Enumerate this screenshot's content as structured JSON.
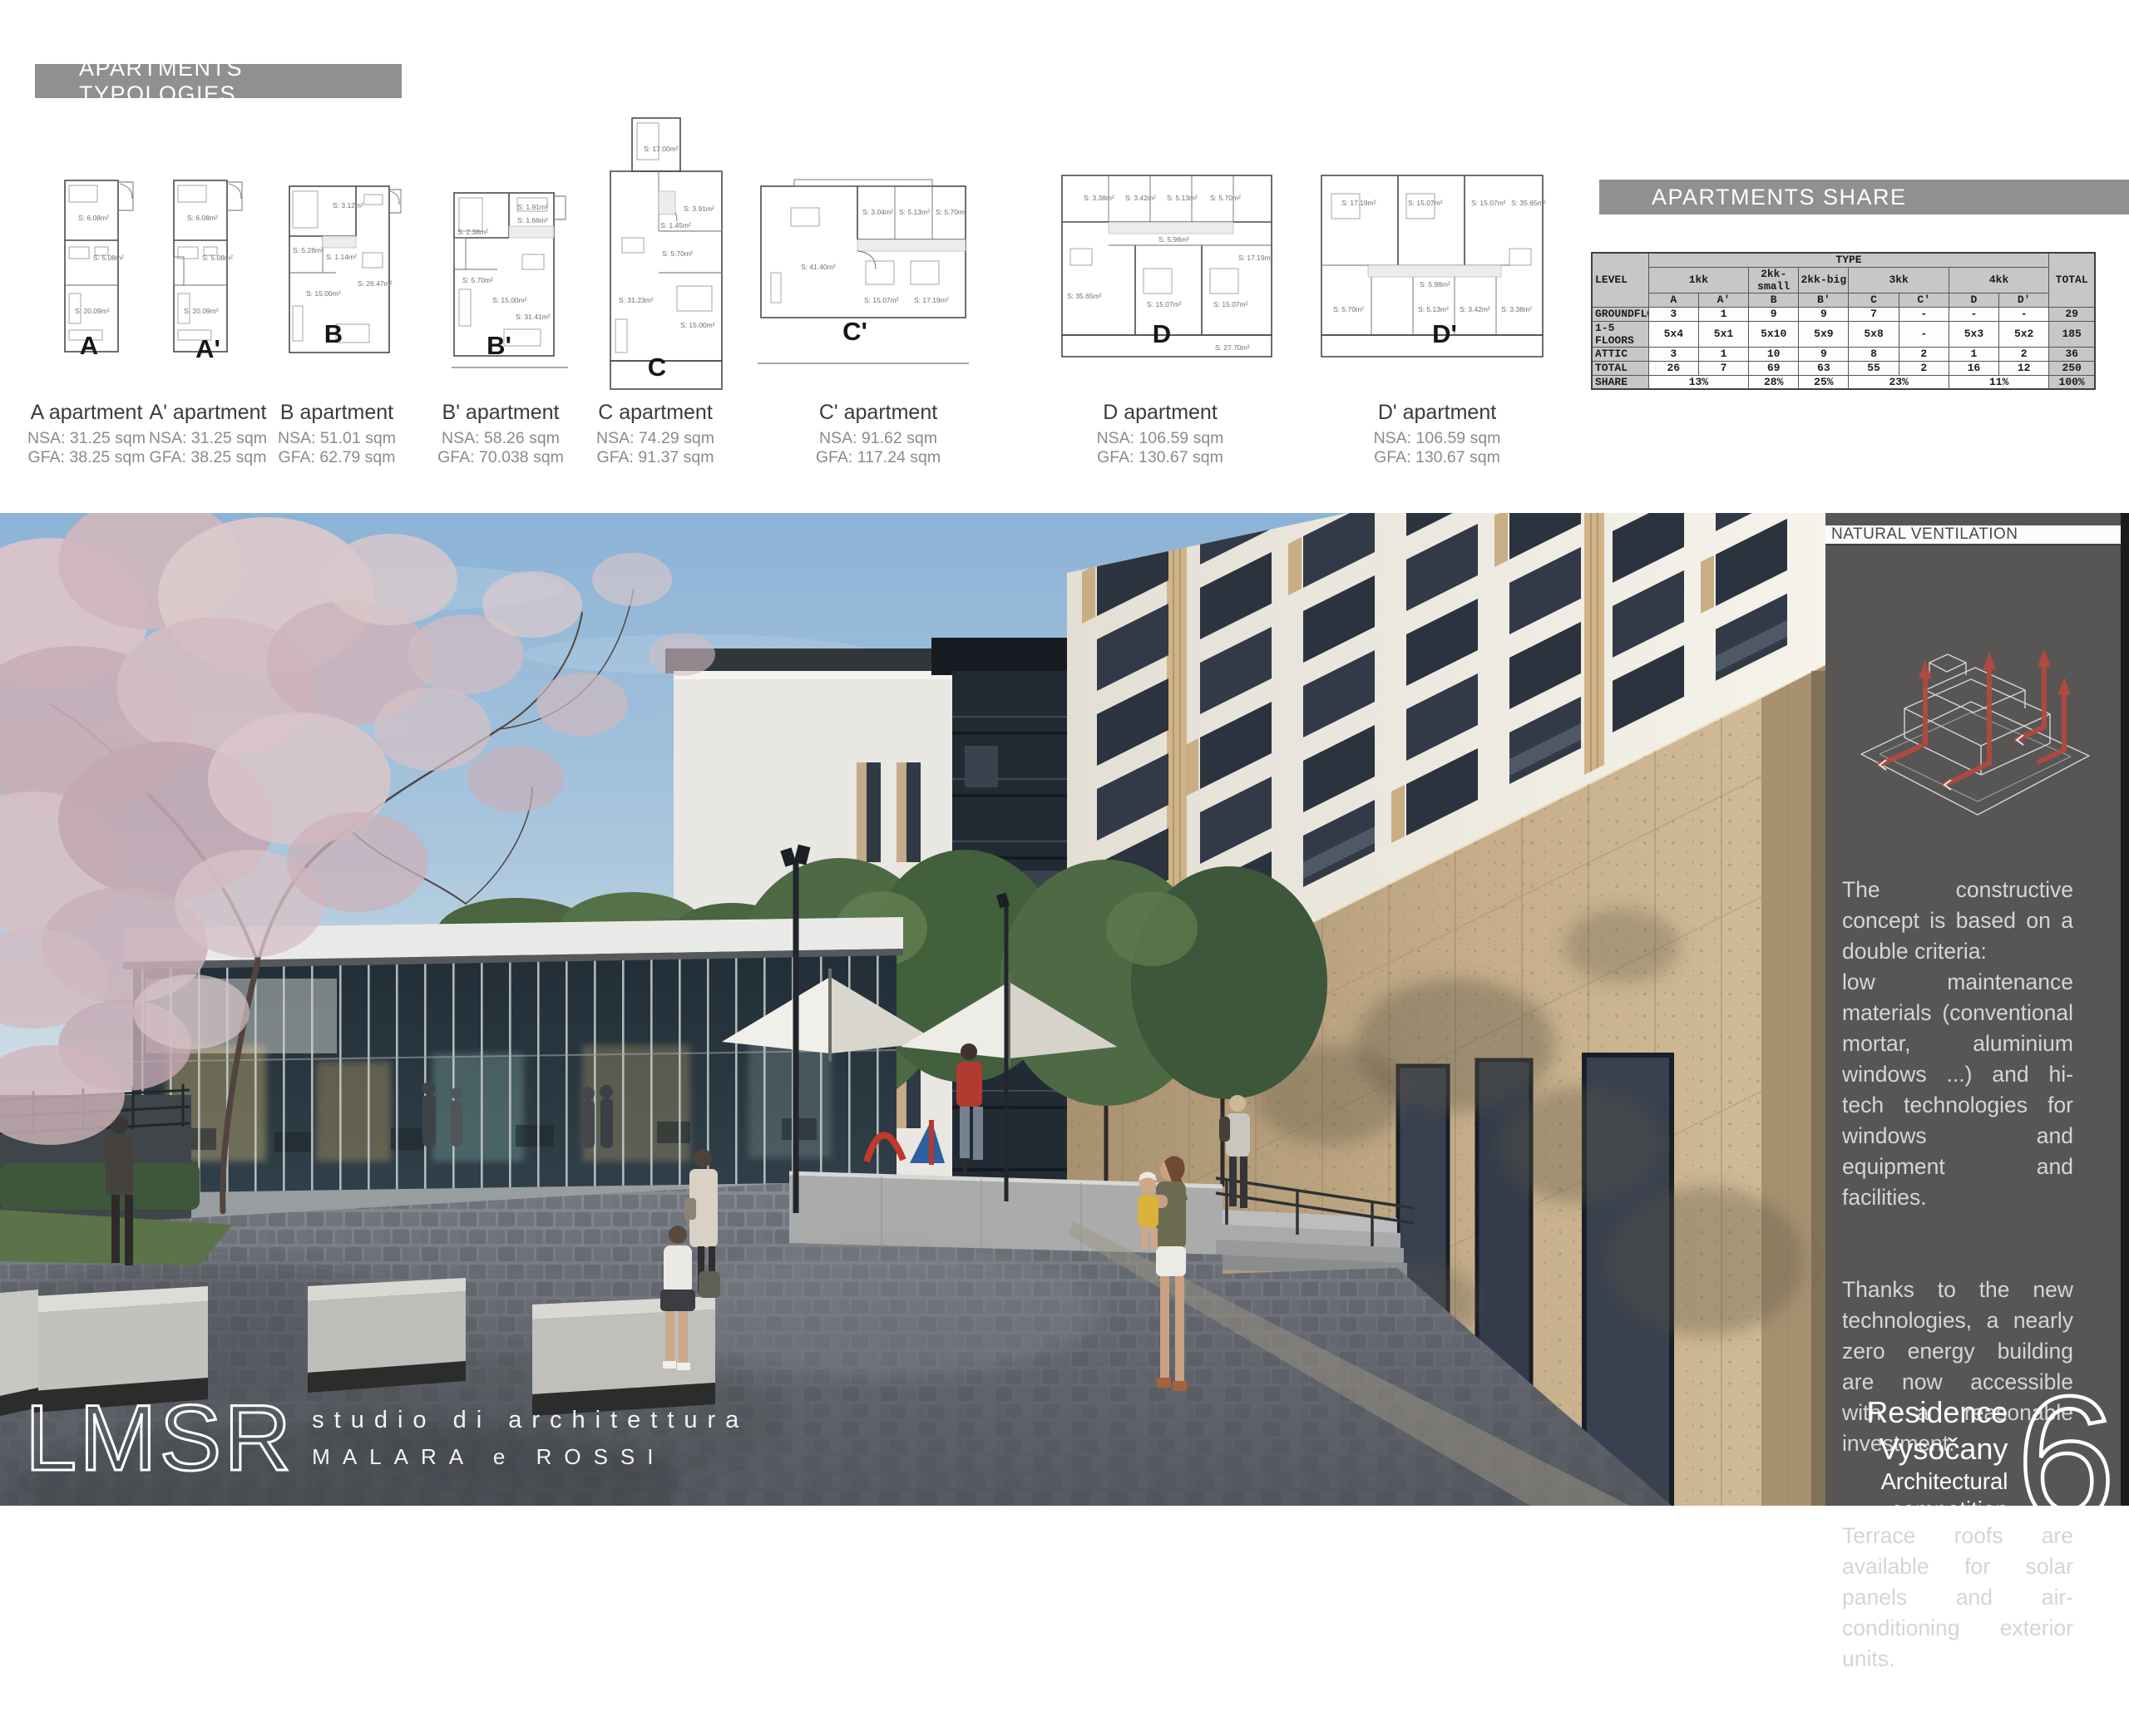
{
  "board": {
    "page_number": "6",
    "project": "Residence Vysočany",
    "competition": "Architectural competition"
  },
  "headers": {
    "typologies": "APARTMENTS TYPOLOGIES",
    "share": "APARTMENTS SHARE",
    "ventilation": "NATURAL VENTILATION"
  },
  "logo": {
    "name": "LMSR",
    "line1": "studio di architettura",
    "line2": "MALARA e ROSSI"
  },
  "typologies": [
    {
      "letter": "A",
      "title": "A apartment",
      "nsa": "NSA: 31.25 sqm",
      "gfa": "GFA: 38.25 sqm",
      "areas": [
        "S: 6.08m²",
        "S: 5.08m²",
        "S: 20.09m²"
      ]
    },
    {
      "letter": "A'",
      "title": "A' apartment",
      "nsa": "NSA: 31.25 sqm",
      "gfa": "GFA: 38.25 sqm",
      "areas": [
        "S: 6.08m²",
        "S: 5.08m²",
        "S: 20.09m²"
      ]
    },
    {
      "letter": "B",
      "title": "B apartment",
      "nsa": "NSA: 51.01 sqm",
      "gfa": "GFA: 62.79 sqm",
      "areas": [
        "S: 3.12m²",
        "S: 5.28m²",
        "S: 1.14m²",
        "S: 26.47m²",
        "S: 15.00m²"
      ]
    },
    {
      "letter": "B'",
      "title": "B' apartment",
      "nsa": "NSA: 58.26 sqm",
      "gfa": "GFA: 70.038 sqm",
      "areas": [
        "S: 1.91m²",
        "S: 1.66m²",
        "S: 2.38m²",
        "S: 5.70m²",
        "S: 15.00m²",
        "S: 31.41m²"
      ]
    },
    {
      "letter": "C",
      "title": "C apartment",
      "nsa": "NSA: 74.29 sqm",
      "gfa": "GFA: 91.37 sqm",
      "areas": [
        "S: 17.00m²",
        "S: 3.91m²",
        "S: 1.45m²",
        "S: 5.70m²",
        "S: 15.00m²",
        "S: 31.23m²"
      ]
    },
    {
      "letter": "C'",
      "title": "C' apartment",
      "nsa": "NSA: 91.62 sqm",
      "gfa": "GFA: 117.24 sqm",
      "areas": [
        "S: 3.04m²",
        "S: 5.13m²",
        "S: 5.70m²",
        "S: 41.40m²",
        "S: 15.07m²",
        "S: 17.19m²"
      ]
    },
    {
      "letter": "D",
      "title": "D apartment",
      "nsa": "NSA: 106.59 sqm",
      "gfa": "GFA: 130.67 sqm",
      "areas": [
        "S: 3.38m²",
        "S: 3.42m²",
        "S: 5.13m²",
        "S: 5.70m²",
        "S: 5.98m²",
        "S: 35.65m²",
        "S: 15.07m²",
        "S: 15.07m²",
        "S: 17.19m²",
        "S: 27.70m²"
      ]
    },
    {
      "letter": "D'",
      "title": "D' apartment",
      "nsa": "NSA: 106.59 sqm",
      "gfa": "GFA: 130.67 sqm",
      "areas": [
        "S: 17.19m²",
        "S: 15.07m²",
        "S: 15.07m²",
        "S: 35.65m²",
        "S: 5.98m²",
        "S: 5.70m²",
        "S: 5.13m²",
        "S: 3.42m²",
        "S: 3.38m²"
      ]
    }
  ],
  "share_table": {
    "level_header": "LEVEL",
    "type_header": "TYPE",
    "total_header": "TOTAL",
    "groups": [
      "1kk",
      "2kk-small",
      "2kk-big",
      "3kk",
      "4kk"
    ],
    "cols": [
      "A",
      "A'",
      "B",
      "B'",
      "C",
      "C'",
      "D",
      "D'"
    ],
    "rows": [
      {
        "label": "GROUNDFLOOR",
        "cells": [
          "3",
          "1",
          "9",
          "9",
          "7",
          "-",
          "-",
          "-"
        ],
        "total": "29"
      },
      {
        "label": "1-5 FLOORS",
        "cells": [
          "5x4",
          "5x1",
          "5x10",
          "5x9",
          "5x8",
          "-",
          "5x3",
          "5x2"
        ],
        "total": "185"
      },
      {
        "label": "ATTIC",
        "cells": [
          "3",
          "1",
          "10",
          "9",
          "8",
          "2",
          "1",
          "2"
        ],
        "total": "36"
      },
      {
        "label": "TOTAL",
        "cells": [
          "26",
          "7",
          "69",
          "63",
          "55",
          "2",
          "16",
          "12"
        ],
        "total": "250"
      }
    ],
    "share_row": {
      "label": "SHARE",
      "cells": [
        "13%",
        "28%",
        "25%",
        "23%",
        "11%"
      ],
      "total": "100%"
    }
  },
  "ventilation_paragraphs": [
    "The constructive concept is based on a double criteria:\nlow maintenance materials (conventional mortar, aluminium windows ...) and hi-tech technologies for windows and equipment and facilities.",
    "Thanks to the new technologies, a nearly zero energy building are now accessible with a reasonable investment.",
    "Terrace roofs are available for solar panels and air-conditioning exterior units."
  ],
  "colors": {
    "banner_gray": "#8f9090",
    "sidebar_gray": "#585555",
    "accent_red": "#b5493f",
    "stone_tan": "#c4ad8c",
    "sky_blue": "#8cb3d6"
  }
}
